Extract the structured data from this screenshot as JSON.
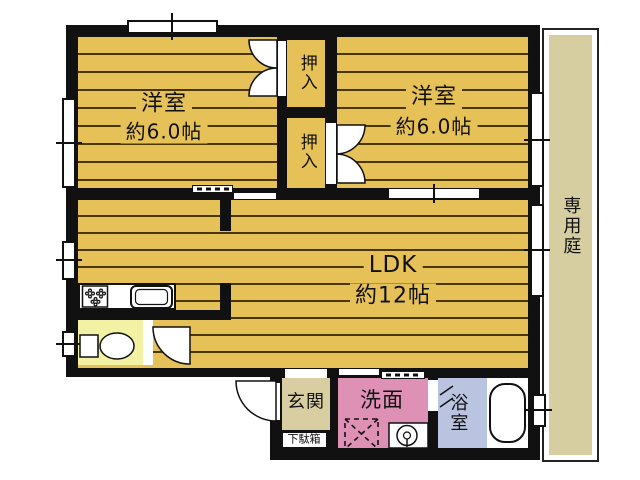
{
  "rooms": {
    "bedroom1": {
      "name": "洋室",
      "size": "約6.0帖"
    },
    "bedroom2": {
      "name": "洋室",
      "size": "約6.0帖"
    },
    "ldk": {
      "name": "LDK",
      "size": "約12帖"
    },
    "closet1": {
      "name": "押入"
    },
    "closet2": {
      "name": "押入"
    },
    "entrance": {
      "name": "玄関"
    },
    "shoe_cabinet": {
      "name": "下駄箱"
    },
    "washroom": {
      "name": "洗面"
    },
    "bathroom": {
      "name": "浴室"
    },
    "private_garden": {
      "name": "専用庭"
    }
  },
  "colors": {
    "wall": "#111111",
    "floor_gold": "#E5C158",
    "floor_stripe": "#4A3700",
    "toilet_yellow": "#F3F1A4",
    "entrance_beige": "#D9CEA2",
    "garden_beige": "#D6CDA0",
    "washroom_pink": "#DE90B5",
    "bathroom_blue": "#BAC4E1",
    "background": "#FFFFFF"
  }
}
